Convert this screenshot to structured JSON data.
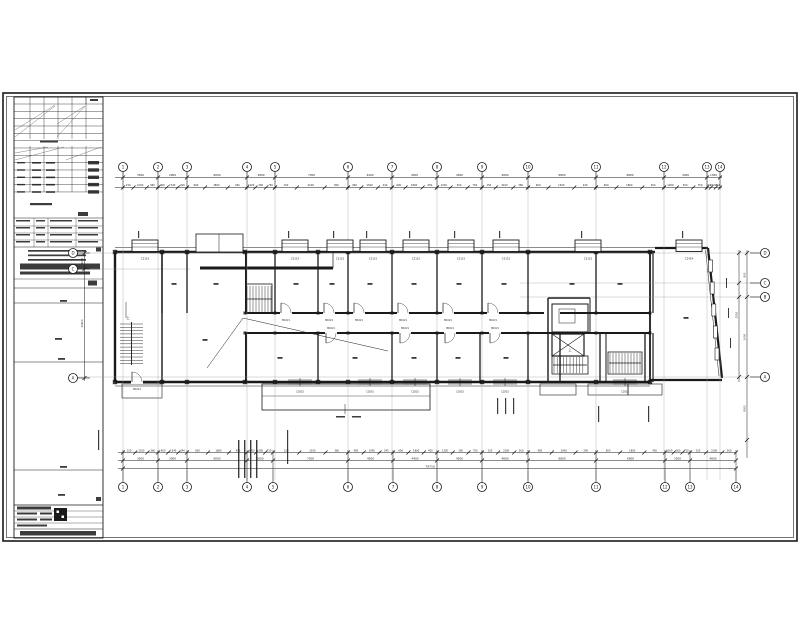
{
  "drawing": {
    "kind": "architectural floor plan (CAD sheet)",
    "sheet_note_label": "上"
  },
  "colors": {
    "ink": "#1a1a1a",
    "paper": "#ffffff",
    "faint": "#999999"
  },
  "axes": {
    "top": {
      "y": 167,
      "labels": [
        "1",
        "2",
        "3",
        "4",
        "5",
        "6",
        "7",
        "8",
        "9",
        "10",
        "11",
        "12",
        "13",
        "14"
      ],
      "x": [
        123,
        158,
        187,
        247,
        275,
        348,
        392,
        437,
        482,
        528,
        596,
        664,
        707,
        720
      ]
    },
    "bottom": {
      "y": 487,
      "labels": [
        "1",
        "2",
        "3",
        "4",
        "5",
        "6",
        "7",
        "8",
        "9",
        "10",
        "11",
        "12",
        "13",
        "14"
      ],
      "x": [
        123,
        158,
        187,
        247,
        273,
        348,
        393,
        437,
        482,
        528,
        596,
        665,
        690,
        736
      ]
    },
    "left": {
      "x": 73,
      "labels": [
        "D",
        "C",
        "A"
      ],
      "y": [
        253,
        269,
        378
      ]
    },
    "right": {
      "x": 765,
      "labels": [
        "D",
        "C",
        "B",
        "A"
      ],
      "y": [
        253,
        283,
        297,
        377
      ]
    }
  },
  "dims": {
    "top_bays": [
      "3500",
      "2900",
      "6000",
      "2800",
      "7300",
      "4400",
      "4500",
      "4500",
      "4600",
      "6800",
      "6800",
      "4300",
      "1300"
    ],
    "bottom_bays": [
      "3500",
      "2900",
      "6000",
      "2600",
      "7500",
      "4500",
      "4400",
      "4500",
      "4600",
      "6800",
      "6900",
      "2500",
      "4600"
    ],
    "overall": "79710",
    "sub": [
      "150",
      "2100",
      "360",
      "900",
      "1540",
      "240",
      "600",
      "1800",
      "450",
      "1200",
      "300",
      "750"
    ],
    "right": [
      "900",
      "1400",
      "8000",
      "2550"
    ],
    "left": [
      "1600",
      "10900",
      "2400"
    ]
  },
  "windows": {
    "top": [
      {
        "cx": 145,
        "code": "C2115"
      },
      {
        "cx": 295,
        "code": "C2115"
      },
      {
        "cx": 340,
        "code": "C2115"
      },
      {
        "cx": 373,
        "code": "C2115"
      },
      {
        "cx": 416,
        "code": "C2115"
      },
      {
        "cx": 461,
        "code": "C2115"
      },
      {
        "cx": 506,
        "code": "C2115"
      },
      {
        "cx": 588,
        "code": "C2115"
      },
      {
        "cx": 689,
        "code": "C2424"
      }
    ],
    "bottom_cx": [
      300,
      370,
      415,
      460,
      505,
      625
    ],
    "bottom_code": "C1815"
  },
  "doors": {
    "upper_x": [
      281,
      324,
      354,
      398,
      443,
      488
    ],
    "lower_x": [
      326,
      400,
      445,
      490
    ],
    "code": "M1021"
  },
  "stairs": {
    "up_label": "上"
  }
}
